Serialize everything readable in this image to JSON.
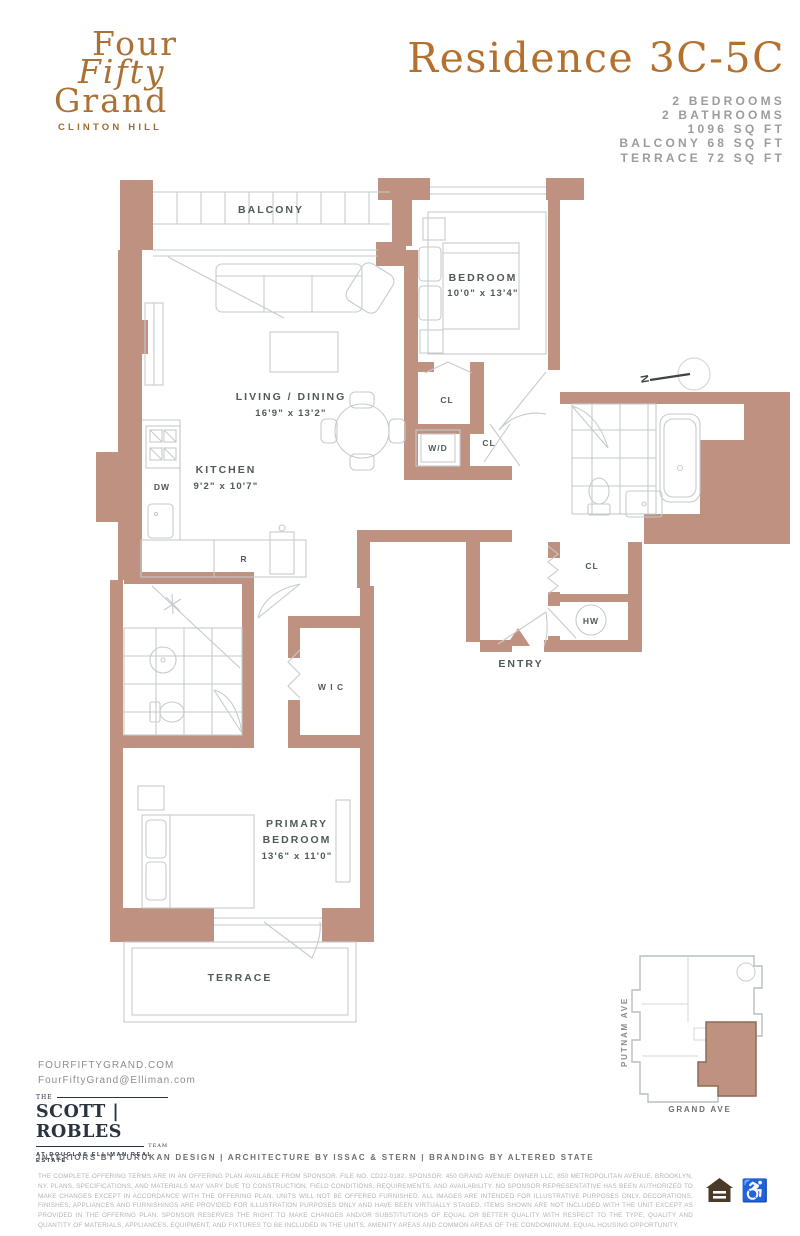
{
  "colors": {
    "wall": "#bf9181",
    "wall_outline": "#8f6a55",
    "accent": "#b4712d",
    "plan_line": "#c6cbcd",
    "label": "#4f5a57",
    "icon_brown": "#4a3a28"
  },
  "brand": {
    "line1": "Four",
    "line2": "Fifty",
    "line3": "Grand",
    "sub": "CLINTON HILL"
  },
  "header": {
    "title": "Residence 3C-5C",
    "specs": [
      "2 BEDROOMS",
      "2 BATHROOMS",
      "1096 SQ FT",
      "BALCONY 68 SQ FT",
      "TERRACE 72 SQ FT"
    ]
  },
  "plan": {
    "balcony": "BALCONY",
    "bedroom_name": "BEDROOM",
    "bedroom_dims": "10'0\" x 13'4\"",
    "living_name": "LIVING / DINING",
    "living_dims": "16'9\" x 13'2\"",
    "kitchen_name": "KITCHEN",
    "kitchen_dims": "9'2\" x 10'7\"",
    "primary_line1": "PRIMARY",
    "primary_line2": "BEDROOM",
    "primary_dims": "13'6\" x 11'0\"",
    "terrace": "TERRACE",
    "entry": "ENTRY",
    "wic": "W I C",
    "cl": "CL",
    "wd": "W/D",
    "hw": "HW",
    "dw": "DW",
    "r": "R",
    "north": "N"
  },
  "minimap": {
    "street_left": "PUTNAM AVE",
    "street_bottom": "GRAND AVE"
  },
  "footer": {
    "website": "FOURFIFTYGRAND.COM",
    "email": "FourFiftyGrand@Elliman.com",
    "team_the": "THE",
    "team_name": "SCOTT | ROBLES",
    "team_team": "TEAM",
    "team_sub": "AT DOUGLAS ELLIMAN REAL ESTATE",
    "credits": "INTERIORS BY DURUKAN DESIGN | ARCHITECTURE BY ISSAC & STERN | BRANDING BY ALTERED STATE",
    "disclaimer": "THE COMPLETE OFFERING TERMS ARE IN AN OFFERING PLAN AVAILABLE FROM SPONSOR. FILE NO. CD22-0182. SPONSOR: 450 GRAND AVENUE OWNER LLC, 850 METROPOLITAN AVENUE, BROOKLYN, NY. PLANS, SPECIFICATIONS, AND MATERIALS MAY VARY DUE TO CONSTRUCTION, FIELD CONDITIONS, REQUIREMENTS, AND AVAILABILITY. NO SPONSOR REPRESENTATIVE HAS BEEN AUTHORIZED TO MAKE CHANGES EXCEPT IN ACCORDANCE WITH THE OFFERING PLAN. UNITS WILL NOT BE OFFERED FURNISHED. ALL IMAGES ARE INTENDED FOR ILLUSTRATIVE PURPOSES ONLY. DECORATIONS, FINISHES, APPLIANCES AND FURNISHINGS ARE PROVIDED FOR ILLUSTRATION PURPOSES ONLY AND HAVE BEEN VIRTUALLY STAGED. ITEMS SHOWN ARE NOT INCLUDED WITH THE UNIT EXCEPT AS PROVIDED IN THE OFFERING PLAN. SPONSOR RESERVES THE RIGHT TO MAKE CHANGES AND/OR SUBSTITUTIONS OF EQUAL OR BETTER QUALITY WITH RESPECT TO THE TYPE, QUALITY AND QUANTITY OF MATERIALS, APPLIANCES, EQUIPMENT, AND FIXTURES TO BE INCLUDED IN THE UNITS, AMENITY AREAS AND COMMON AREAS OF THE CONDOMINIUM. EQUAL HOUSING OPPORTUNITY."
  }
}
